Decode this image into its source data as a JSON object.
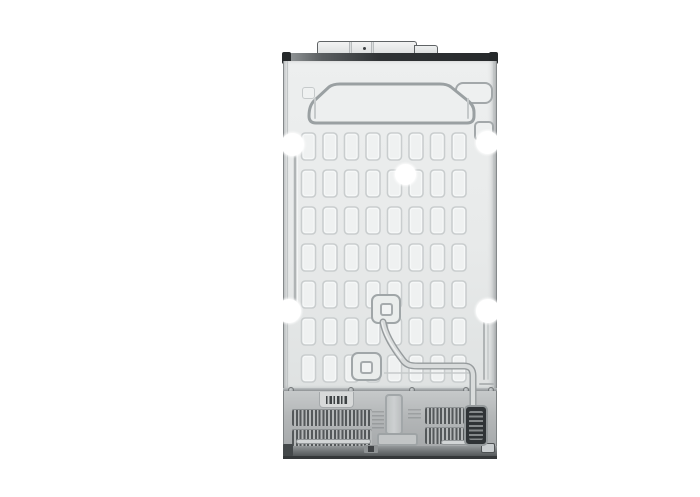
{
  "meta": {
    "alt": "Rear view product photo of a side-by-side refrigerator: light metallic back panel with embossed dash pattern, trapezoid stiffener, white screw-hole plugs, coolant tube routed to lower-right, and a lower machine compartment with ventilation grilles, barcode label and dark compressor grille",
    "background": "#ffffff"
  },
  "colors": {
    "panel": "#e9ebeb",
    "panel_edge": "#85898b",
    "emboss_outline": "#c9cdce",
    "strong_outline": "#9aa0a2",
    "top_strip_dark": "#2f3234",
    "compartment": "#b6b9ba",
    "vent_slat": "#54585a",
    "dark_grille": "#2f3336",
    "base_strip": "#6f7375",
    "screw_hole_plug": "#ffffff",
    "tube": "#d9dcdc"
  },
  "parts": {
    "top_cover": "hinge cover",
    "back_panel": "embossed back panel",
    "trapezoid": "upper stiffener emboss",
    "tube": "coolant tube",
    "label": "barcode label",
    "vents": "ventilation grilles",
    "compressor_grille": "dark compressor grille",
    "base": "base strip with feet"
  }
}
